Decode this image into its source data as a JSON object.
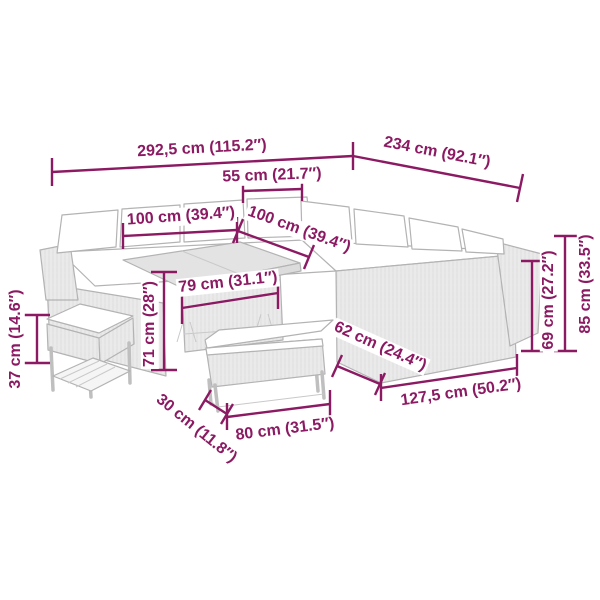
{
  "diagram": {
    "type": "product-dimension-diagram",
    "product": "garden-lounge-set-with-table-bench-and-stool",
    "colors": {
      "dimension": "#8B1A63",
      "furniture_line": "#b3b3b3",
      "cushion": "#ffffff"
    },
    "dimensions": [
      {
        "id": "overall-width",
        "label": "292,5 cm (115.2″)"
      },
      {
        "id": "overall-depth",
        "label": "234 cm (92.1″)"
      },
      {
        "id": "corner-seat-width",
        "label": "55 cm (21.7″)"
      },
      {
        "id": "table-length",
        "label": "100 cm (39.4″)"
      },
      {
        "id": "table-width",
        "label": "100 cm (39.4″)"
      },
      {
        "id": "table-inner-width",
        "label": "79 cm (31.1″)"
      },
      {
        "id": "table-height",
        "label": "71 cm (28″)"
      },
      {
        "id": "stool-height",
        "label": "37 cm (14.6″)"
      },
      {
        "id": "bench-depth",
        "label": "30 cm (11.8″)"
      },
      {
        "id": "bench-length",
        "label": "80 cm (31.5″)"
      },
      {
        "id": "sofa-depth",
        "label": "62 cm (24.4″)"
      },
      {
        "id": "sofa-section-length",
        "label": "127,5 cm (50.2″)"
      },
      {
        "id": "armrest-height",
        "label": "69 cm (27.2″)"
      },
      {
        "id": "total-height",
        "label": "85 cm (33.5″)"
      }
    ]
  }
}
